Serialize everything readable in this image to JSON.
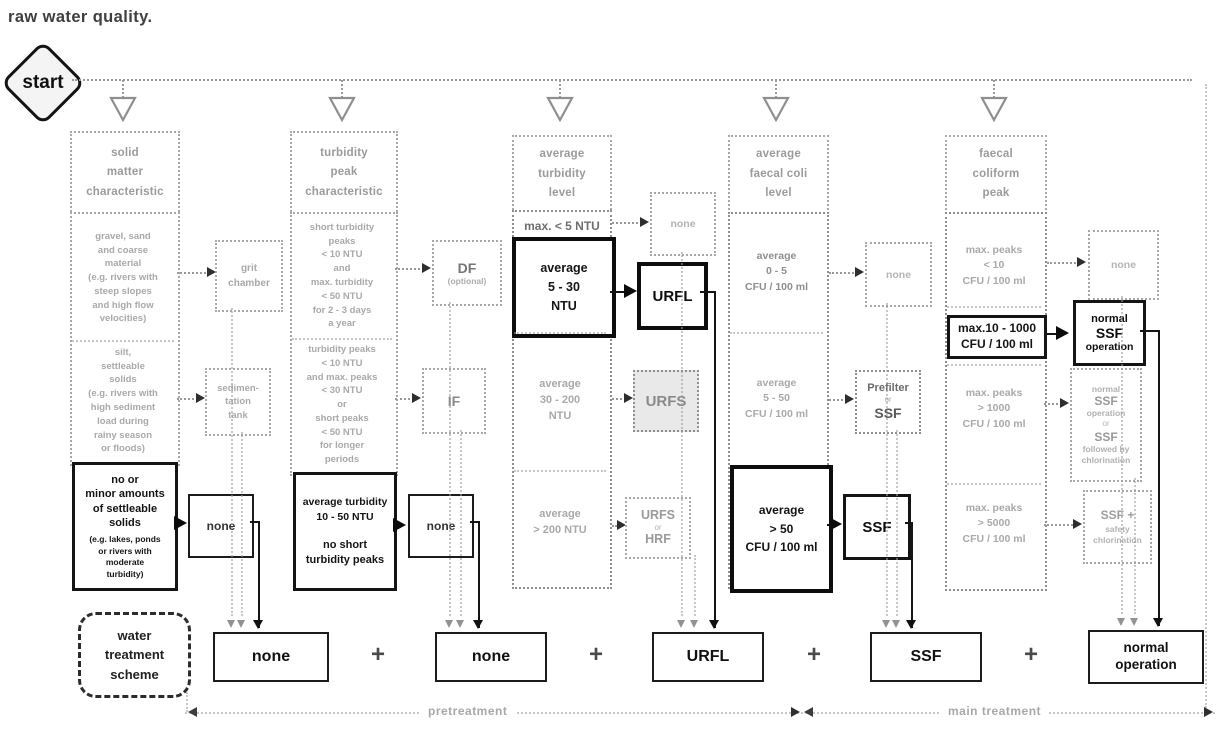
{
  "title": "raw water quality.",
  "start_label": "start",
  "colors": {
    "ink": "#141414",
    "faded": "#a9a9a9",
    "fill_light": "#e9e9e9"
  },
  "columns": [
    {
      "header": "solid\nmatter\ncharacteristic",
      "row1_condition": "gravel, sand\nand coarse\nmaterial\n(e.g. rivers with\nsteep slopes\nand high flow\nvelocities)",
      "row1_result": "grit\nchamber",
      "row2_condition": "silt,\nsettleable\nsolids\n(e.g. rivers with\nhigh sediment\nload during\nrainy season\nor floods)",
      "row2_result": "sedimen-\ntation\ntank",
      "row3_condition": "no or\nminor amounts\nof settleable\nsolids",
      "row3_condition_note": "(e.g. lakes, ponds\nor rivers with\nmoderate\nturbidity)",
      "row3_result": "none"
    },
    {
      "header": "turbidity\npeak\ncharacteristic",
      "row1_condition": "short turbidity\npeaks\n< 10 NTU\nand\nmax. turbidity\n< 50 NTU\nfor 2 - 3 days\na year",
      "row1_result": "DF",
      "row1_result_note": "(optional)",
      "row2_condition": "turbidity peaks\n< 10 NTU\nand max. peaks\n< 30 NTU\nor\nshort peaks\n< 50 NTU\nfor longer\nperiods",
      "row2_result": "IF",
      "row3_condition_top": "average turbidity\n10 - 50 NTU",
      "row3_condition_bottom": "no short\nturbidity peaks",
      "row3_result": "none"
    },
    {
      "header": "average\nturbidity\nlevel",
      "row1_condition": "max. < 5 NTU",
      "row1_result": "none",
      "row2_condition": "average\n5 - 30\nNTU",
      "row2_result": "URFL",
      "row3_condition": "average\n30 - 200\nNTU",
      "row3_result": "URFS",
      "row4_condition": "average\n> 200 NTU",
      "row4_result_l1": "URFS",
      "row4_result_l2": "or",
      "row4_result_l3": "HRF"
    },
    {
      "header": "average\nfaecal coli\nlevel",
      "row1_condition": "average\n0 - 5\nCFU / 100 ml",
      "row1_result": "none",
      "row2_condition": "average\n5 - 50\nCFU / 100 ml",
      "row2_result_l1": "Prefilter",
      "row2_result_l2": "or",
      "row2_result_l3": "SSF",
      "row3_condition": "average\n> 50\nCFU / 100 ml",
      "row3_result": "SSF"
    },
    {
      "header": "faecal\ncoliform\npeak",
      "row1_condition": "max. peaks\n< 10\nCFU / 100 ml",
      "row1_result": "none",
      "row2_condition": "max.10 - 1000\nCFU / 100 ml",
      "row2_result_l1": "normal",
      "row2_result_l2": "SSF",
      "row2_result_l3": "operation",
      "row3_condition": "max. peaks\n> 1000\nCFU / 100 ml",
      "row3_result_l1": "normal",
      "row3_result_l2": "SSF",
      "row3_result_l3": "operation",
      "row3_result_l4": "or",
      "row3_result_l5": "SSF",
      "row3_result_l6": "followed by",
      "row3_result_l7": "chlorination",
      "row4_condition": "max. peaks\n> 5000\nCFU / 100 ml",
      "row4_result_l1": "SSF +",
      "row4_result_l2": "safety",
      "row4_result_l3": "chlorination"
    }
  ],
  "scheme": {
    "label": "water\ntreatment\nscheme",
    "box1": "none",
    "box2": "none",
    "box3": "URFL",
    "box4": "SSF",
    "box5": "normal\noperation",
    "plus": "+"
  },
  "footer": {
    "left_label": "pretreatment",
    "right_label": "main treatment"
  }
}
